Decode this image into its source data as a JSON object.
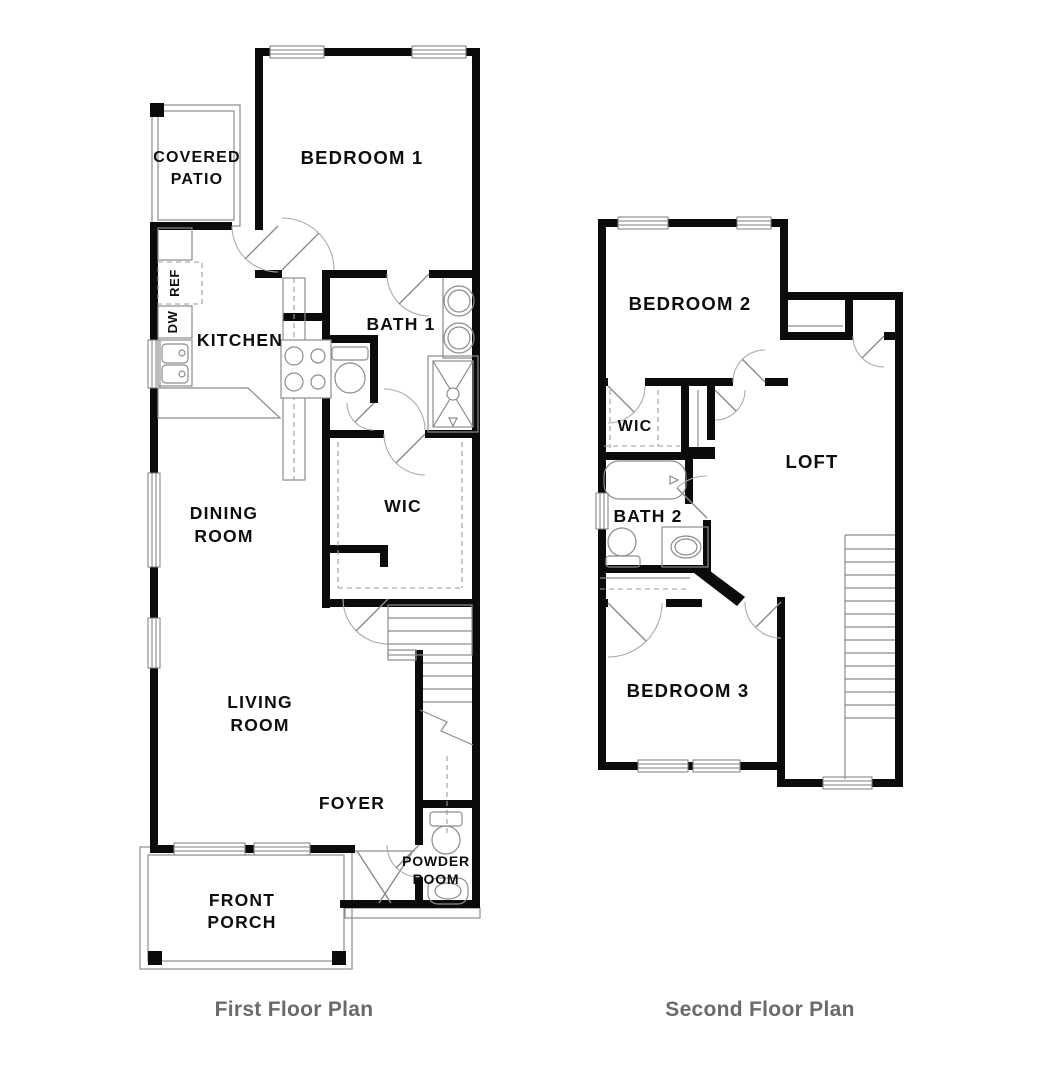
{
  "colors": {
    "wall": "#0b0b0b",
    "fixture_line": "#8c8c8c",
    "window_line": "#7e7e7e",
    "door_arc": "#ababab",
    "label": "#0e0e0e",
    "caption": "#6a6a6a"
  },
  "first_floor": {
    "caption": "First Floor Plan",
    "labels": {
      "covered_patio_1": "COVERED",
      "covered_patio_2": "PATIO",
      "bedroom1": "BEDROOM 1",
      "kitchen": "KITCHEN",
      "ref": "REF",
      "dw": "DW",
      "bath1": "BATH 1",
      "dining_1": "DINING",
      "dining_2": "ROOM",
      "wic": "WIC",
      "living_1": "LIVING",
      "living_2": "ROOM",
      "foyer": "FOYER",
      "powder_1": "POWDER",
      "powder_2": "ROOM",
      "porch_1": "FRONT",
      "porch_2": "PORCH"
    }
  },
  "second_floor": {
    "caption": "Second Floor Plan",
    "labels": {
      "bedroom2": "BEDROOM 2",
      "wic": "WIC",
      "loft": "LOFT",
      "bath2": "BATH 2",
      "bedroom3": "BEDROOM 3"
    }
  }
}
